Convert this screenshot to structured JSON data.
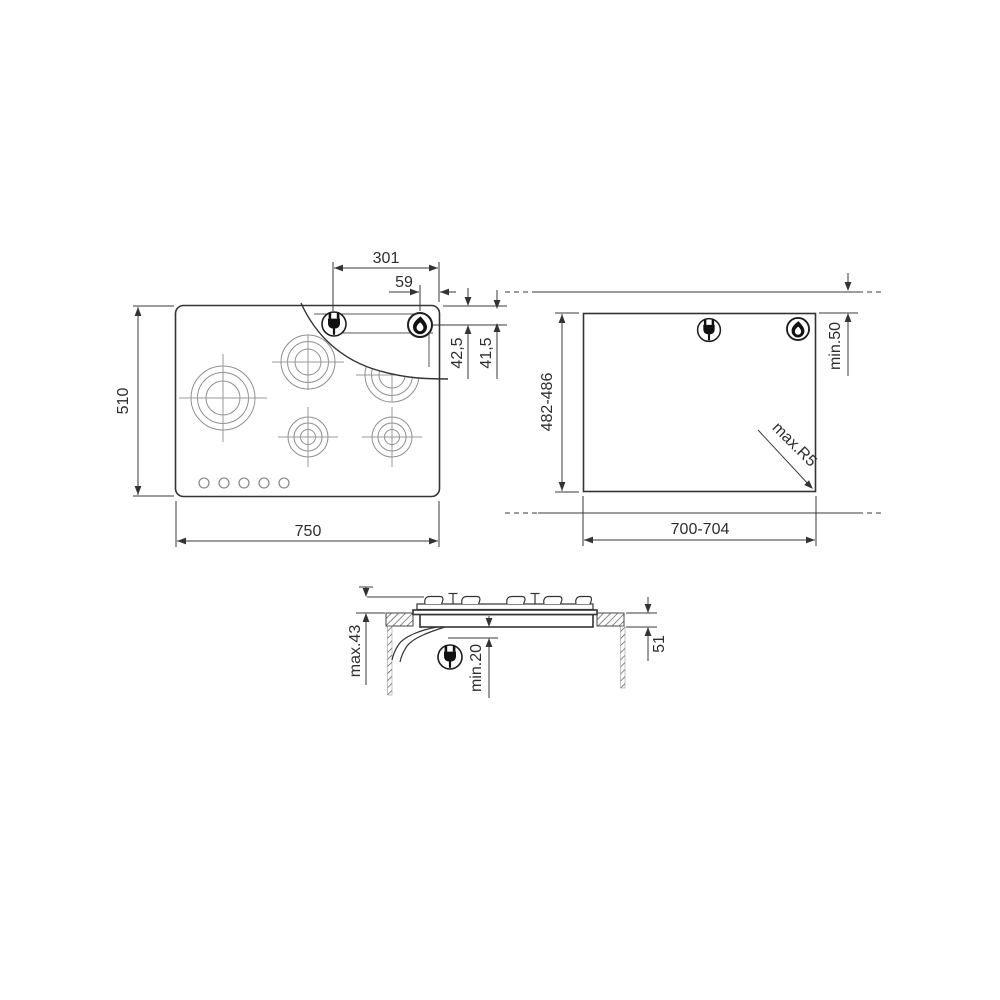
{
  "colors": {
    "line": "#3a3a3a",
    "text": "#2d2d2d",
    "background": "#ffffff"
  },
  "plan_view": {
    "dim_width": "750",
    "dim_depth": "510",
    "dim_plug_to_right_edge": "301",
    "dim_flame_to_right_edge": "59",
    "dim_gas_from_hob_edge": "42,5",
    "dim_gas_from_cutout_edge": "41,5",
    "burner_count": 5,
    "knob_count": 5,
    "icons": [
      "plug-icon",
      "flame-icon"
    ]
  },
  "cutout_view": {
    "dim_width": "700-704",
    "dim_depth": "482-486",
    "dim_rear_clearance": "min.50",
    "dim_corner_radius": "max.R5",
    "icons": [
      "plug-icon",
      "flame-icon"
    ]
  },
  "section_view": {
    "dim_height_above_worktop": "max.43",
    "dim_clearance_below": "min.20",
    "dim_recess_depth": "51",
    "icons": [
      "plug-icon"
    ]
  }
}
